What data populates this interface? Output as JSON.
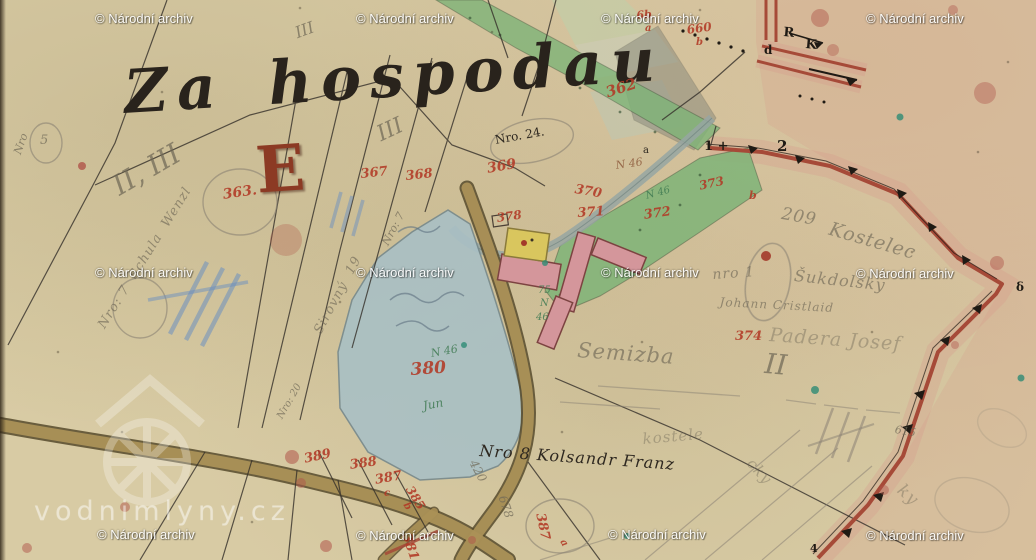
{
  "title": {
    "text": "Za hospodau"
  },
  "section": {
    "letter": "E"
  },
  "watermark": {
    "text": "© Národní archiv",
    "positions": [
      {
        "x": 95,
        "y": 11
      },
      {
        "x": 356,
        "y": 11
      },
      {
        "x": 601,
        "y": 11
      },
      {
        "x": 866,
        "y": 11
      },
      {
        "x": 95,
        "y": 265
      },
      {
        "x": 356,
        "y": 265
      },
      {
        "x": 601,
        "y": 265
      },
      {
        "x": 856,
        "y": 266
      },
      {
        "x": 97,
        "y": 527
      },
      {
        "x": 356,
        "y": 528
      },
      {
        "x": 608,
        "y": 527
      },
      {
        "x": 866,
        "y": 528
      }
    ]
  },
  "site_watermark": {
    "text": "vodnimlyny.cz"
  },
  "colors": {
    "paper": "#d8cba4",
    "carmine": "#a64a38",
    "red_ink": "#b23a26",
    "pencil": "#6f6857",
    "ink": "#2c2620",
    "pond": "#a9c0c5",
    "green": "#7fb478",
    "road_fill": "#ab9157",
    "road_edge": "#564a2c",
    "building_pink": "#d4969b",
    "building_yellow": "#d9c65e",
    "wash_pink": "#d7998b",
    "stream": "#97a6a2",
    "blue_crayon": "#6c8fbf",
    "green_ink": "#3f7a52",
    "watermark": "#ffffff"
  },
  "labels": [
    {
      "t": "362",
      "x": 604,
      "y": 86,
      "s": 15,
      "r": -18,
      "c": "red"
    },
    {
      "t": "363.",
      "x": 222,
      "y": 188,
      "s": 14,
      "r": -8,
      "c": "red"
    },
    {
      "t": "367",
      "x": 360,
      "y": 168,
      "s": 13,
      "r": -6,
      "c": "red"
    },
    {
      "t": "368",
      "x": 405,
      "y": 170,
      "s": 13,
      "r": -6,
      "c": "red"
    },
    {
      "t": "369",
      "x": 486,
      "y": 162,
      "s": 14,
      "r": -10,
      "c": "red"
    },
    {
      "t": "370",
      "x": 576,
      "y": 183,
      "s": 13,
      "r": 10,
      "c": "red"
    },
    {
      "t": "371",
      "x": 577,
      "y": 207,
      "s": 13,
      "r": -4,
      "c": "red"
    },
    {
      "t": "372",
      "x": 643,
      "y": 209,
      "s": 13,
      "r": -8,
      "c": "red"
    },
    {
      "t": "373",
      "x": 698,
      "y": 180,
      "s": 12,
      "r": -12,
      "c": "red"
    },
    {
      "t": "b",
      "x": 749,
      "y": 190,
      "s": 11,
      "r": 0,
      "c": "red"
    },
    {
      "t": "374",
      "x": 735,
      "y": 330,
      "s": 13,
      "r": 0,
      "c": "red"
    },
    {
      "t": "378",
      "x": 496,
      "y": 212,
      "s": 12,
      "r": -8,
      "c": "red"
    },
    {
      "t": "380",
      "x": 410,
      "y": 362,
      "s": 17,
      "r": -4,
      "c": "red"
    },
    {
      "t": "381",
      "x": 412,
      "y": 532,
      "s": 13,
      "r": 72,
      "c": "red"
    },
    {
      "t": "385",
      "x": 414,
      "y": 484,
      "s": 12,
      "r": 58,
      "c": "red"
    },
    {
      "t": "b",
      "x": 409,
      "y": 501,
      "s": 10,
      "r": 58,
      "c": "red"
    },
    {
      "t": "387",
      "x": 374,
      "y": 474,
      "s": 13,
      "r": -10,
      "c": "red"
    },
    {
      "t": "c",
      "x": 384,
      "y": 489,
      "s": 10,
      "r": 0,
      "c": "red"
    },
    {
      "t": "388",
      "x": 349,
      "y": 459,
      "s": 13,
      "r": -8,
      "c": "red"
    },
    {
      "t": "389",
      "x": 303,
      "y": 453,
      "s": 13,
      "r": -12,
      "c": "red"
    },
    {
      "t": "387",
      "x": 546,
      "y": 512,
      "s": 13,
      "r": 78,
      "c": "red"
    },
    {
      "t": "a",
      "x": 566,
      "y": 538,
      "s": 10,
      "r": 60,
      "c": "red"
    },
    {
      "t": "660",
      "x": 686,
      "y": 24,
      "s": 12,
      "r": -8,
      "c": "red"
    },
    {
      "t": "b",
      "x": 696,
      "y": 38,
      "s": 10,
      "r": 0,
      "c": "red"
    },
    {
      "t": "6b",
      "x": 636,
      "y": 10,
      "s": 11,
      "r": -5,
      "c": "red"
    },
    {
      "t": "a",
      "x": 645,
      "y": 24,
      "s": 10,
      "r": 0,
      "c": "red"
    },
    {
      "t": "R",
      "x": 784,
      "y": 26,
      "s": 13,
      "r": 5,
      "c": "ink-bold"
    },
    {
      "t": "K",
      "x": 806,
      "y": 38,
      "s": 13,
      "r": 5,
      "c": "ink-bold"
    },
    {
      "t": "d",
      "x": 764,
      "y": 44,
      "s": 12,
      "r": 0,
      "c": "ink-bold"
    },
    {
      "t": "1 +",
      "x": 704,
      "y": 140,
      "s": 13,
      "r": 0,
      "c": "ink-bold"
    },
    {
      "t": "2",
      "x": 777,
      "y": 139,
      "s": 15,
      "r": 0,
      "c": "ink-bold"
    },
    {
      "t": "δ",
      "x": 1016,
      "y": 281,
      "s": 12,
      "r": 0,
      "c": "ink-bold"
    },
    {
      "t": "4",
      "x": 810,
      "y": 543,
      "s": 11,
      "r": 0,
      "c": "ink-bold"
    },
    {
      "t": "a",
      "x": 643,
      "y": 146,
      "s": 10,
      "r": 0,
      "c": "ink"
    },
    {
      "t": "Nro 8 Kolsandr Franz",
      "x": 480,
      "y": 443,
      "s": 16,
      "r": 4,
      "c": "ink-script"
    },
    {
      "t": "Nro. 24.",
      "x": 494,
      "y": 134,
      "s": 12,
      "r": -10,
      "c": "ink"
    },
    {
      "t": "II, III",
      "x": 108,
      "y": 176,
      "s": 28,
      "r": -30,
      "c": "pencil"
    },
    {
      "t": "III",
      "x": 374,
      "y": 126,
      "s": 22,
      "r": -25,
      "c": "pencil"
    },
    {
      "t": "III",
      "x": 293,
      "y": 26,
      "s": 16,
      "r": -20,
      "c": "pencil"
    },
    {
      "t": "5",
      "x": 40,
      "y": 134,
      "s": 13,
      "r": 0,
      "c": "pencil"
    },
    {
      "t": "Nro",
      "x": 12,
      "y": 152,
      "s": 11,
      "r": -70,
      "c": "pencil"
    },
    {
      "t": "Nro: 7  Schula  Wenzl",
      "x": 96,
      "y": 324,
      "s": 13,
      "r": -58,
      "c": "pencil-script"
    },
    {
      "t": "Sirovný  19",
      "x": 312,
      "y": 330,
      "s": 13,
      "r": -62,
      "c": "pencil-script"
    },
    {
      "t": "Nro: 20",
      "x": 276,
      "y": 416,
      "s": 10,
      "r": -60,
      "c": "pencil"
    },
    {
      "t": "Nro: 7",
      "x": 380,
      "y": 242,
      "s": 11,
      "r": -62,
      "c": "pencil"
    },
    {
      "t": "209",
      "x": 783,
      "y": 206,
      "s": 17,
      "r": 10,
      "c": "pencil-script"
    },
    {
      "t": "Kostelec",
      "x": 832,
      "y": 220,
      "s": 19,
      "r": 16,
      "c": "pencil-script"
    },
    {
      "t": "nro 1",
      "x": 712,
      "y": 268,
      "s": 14,
      "r": -4,
      "c": "pencil-script"
    },
    {
      "t": "Šukdolsky",
      "x": 795,
      "y": 268,
      "s": 16,
      "r": 6,
      "c": "pencil-script"
    },
    {
      "t": "Johann Cristlaid",
      "x": 720,
      "y": 296,
      "s": 12,
      "r": 3,
      "c": "pencil-script"
    },
    {
      "t": "Padera Josef",
      "x": 770,
      "y": 326,
      "s": 19,
      "r": 4,
      "c": "pencil-script faint"
    },
    {
      "t": "Semizba",
      "x": 578,
      "y": 340,
      "s": 21,
      "r": 4,
      "c": "pencil-script"
    },
    {
      "t": "II",
      "x": 766,
      "y": 350,
      "s": 28,
      "r": 5,
      "c": "pencil"
    },
    {
      "t": "420",
      "x": 478,
      "y": 458,
      "s": 12,
      "r": 62,
      "c": "pencil"
    },
    {
      "t": "678",
      "x": 508,
      "y": 494,
      "s": 12,
      "r": 72,
      "c": "pencil"
    },
    {
      "t": "615",
      "x": 896,
      "y": 424,
      "s": 11,
      "r": 10,
      "c": "pencil"
    },
    {
      "t": "kostele",
      "x": 642,
      "y": 432,
      "s": 15,
      "r": -5,
      "c": "pencil-script faint"
    },
    {
      "t": "cky",
      "x": 755,
      "y": 456,
      "s": 15,
      "r": 48,
      "c": "pencil-script faint"
    },
    {
      "t": "ky",
      "x": 905,
      "y": 482,
      "s": 17,
      "r": 42,
      "c": "pencil-script faint"
    },
    {
      "t": "75",
      "x": 538,
      "y": 286,
      "s": 10,
      "r": 0,
      "c": "green-ink"
    },
    {
      "t": "N",
      "x": 540,
      "y": 299,
      "s": 10,
      "r": 0,
      "c": "green-ink"
    },
    {
      "t": "46",
      "x": 536,
      "y": 313,
      "s": 10,
      "r": 0,
      "c": "green-ink"
    },
    {
      "t": "N 46",
      "x": 615,
      "y": 160,
      "s": 11,
      "r": -8,
      "c": "brown-ink"
    },
    {
      "t": "N 46",
      "x": 645,
      "y": 192,
      "s": 10,
      "r": -15,
      "c": "green-ink"
    },
    {
      "t": "N 46",
      "x": 430,
      "y": 348,
      "s": 11,
      "r": -10,
      "c": "green-ink"
    },
    {
      "t": "Jun",
      "x": 422,
      "y": 400,
      "s": 12,
      "r": -10,
      "c": "green-ink"
    }
  ]
}
